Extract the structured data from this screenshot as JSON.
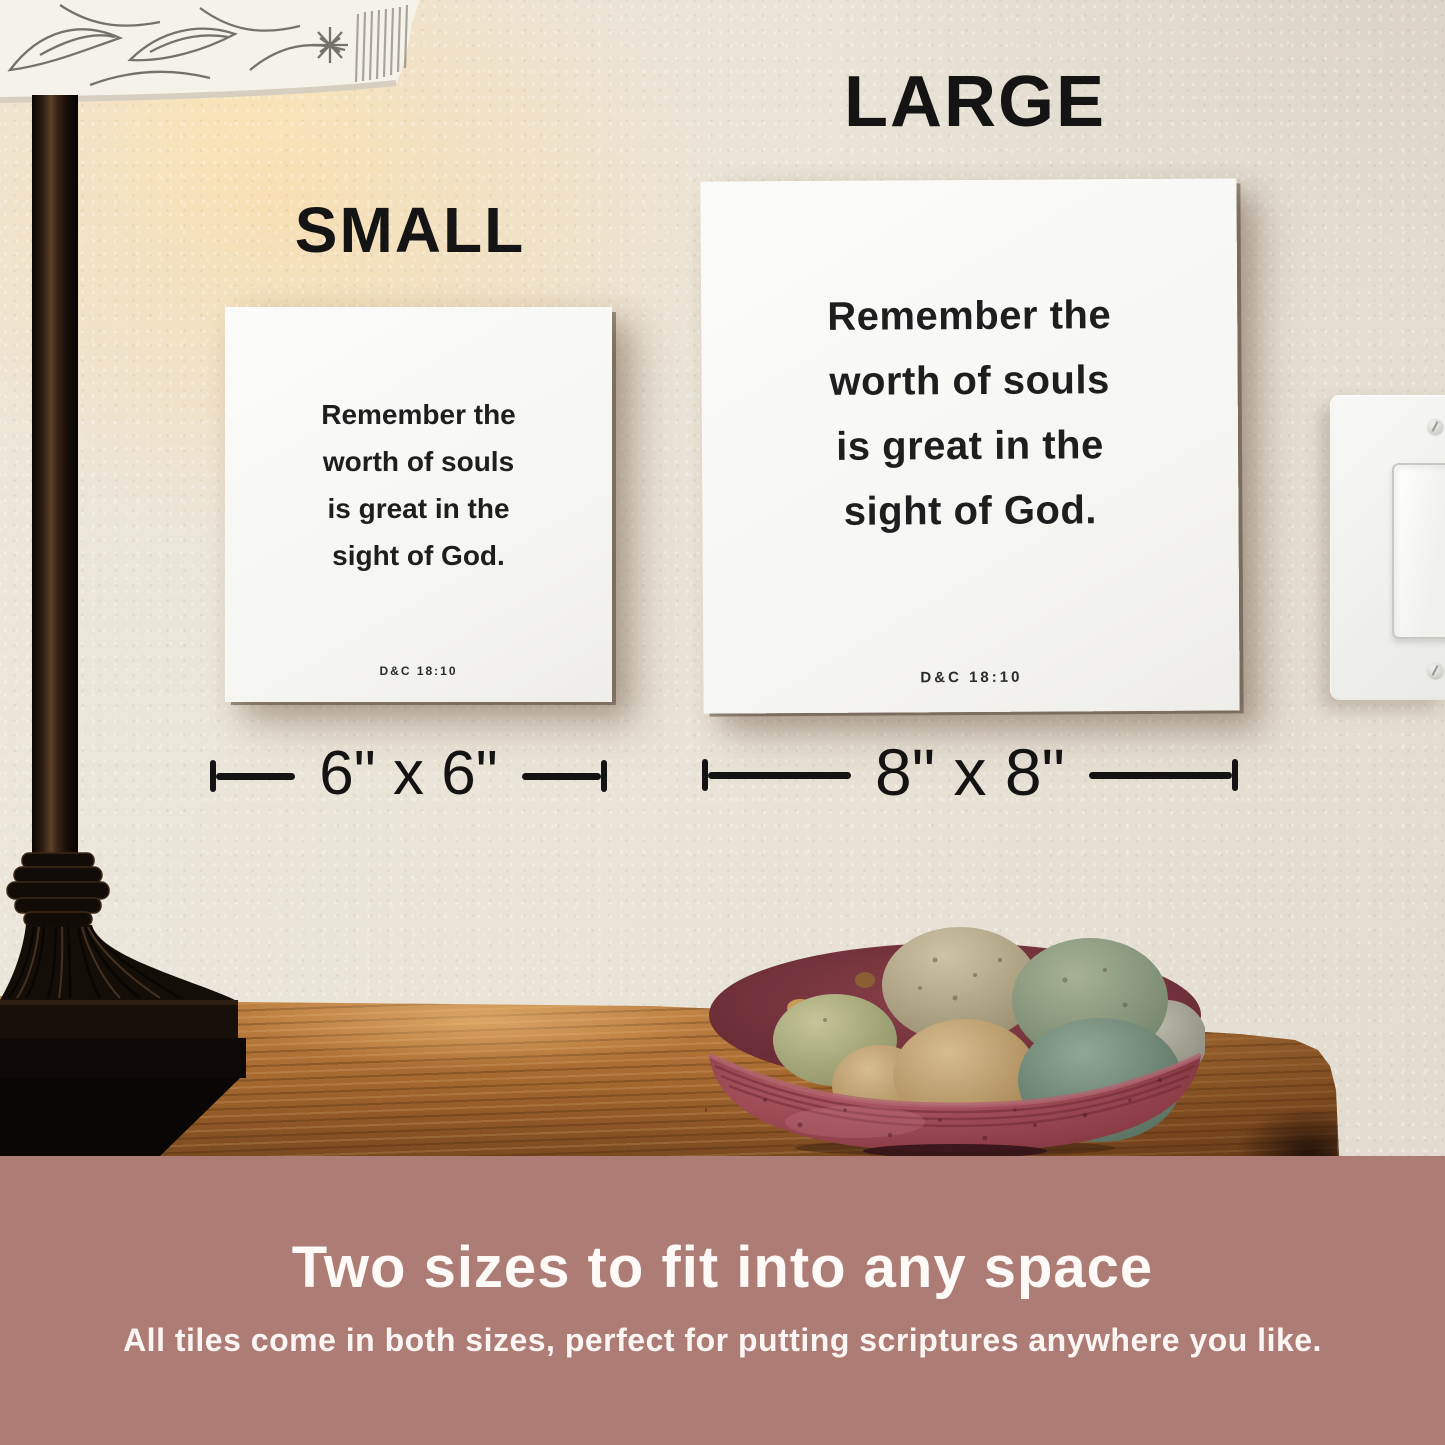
{
  "size_labels": {
    "small": "SMALL",
    "large": "LARGE"
  },
  "tiles": {
    "small": {
      "quote_lines": [
        "Remember the",
        "worth of souls",
        "is great in the",
        "sight of God."
      ],
      "citation": "D&C 18:10",
      "dimension": "6\" x 6\""
    },
    "large": {
      "quote_lines": [
        "Remember the",
        "worth of souls",
        "is great in the",
        "sight of God."
      ],
      "citation": "D&C 18:10",
      "dimension": "8\" x 8\""
    }
  },
  "banner": {
    "headline": "Two sizes to fit into any space",
    "subtext": "All tiles come in both sizes, perfect for putting scriptures anywhere you like."
  },
  "colors": {
    "banner_bg": "#ad7c75",
    "banner_text": "#fdfaf8",
    "wall": "#eae4d8",
    "tile_bg": "#f8f8f6",
    "tile_text": "#1e1e1e",
    "wood": "#a96a2f",
    "bowl": "#8c3a43",
    "lamp": "#140e09"
  }
}
